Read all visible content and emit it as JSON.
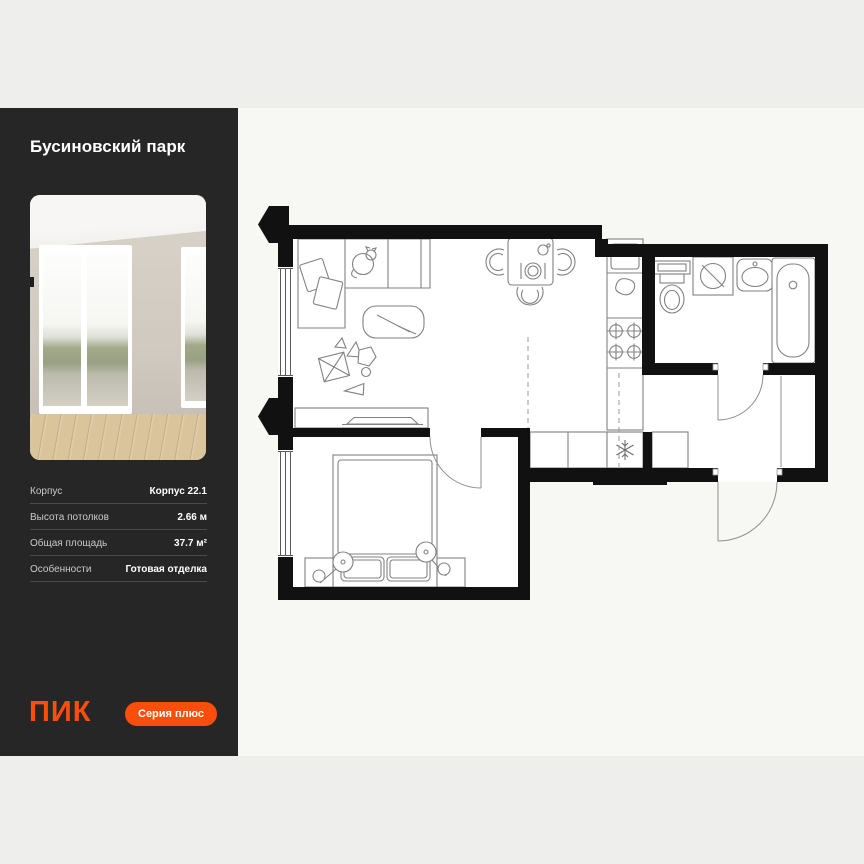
{
  "sidebar": {
    "title": "Бусиновский парк",
    "photo_alt": "interior-photo-empty-room-two-windows-wood-floor",
    "details": [
      {
        "label": "Корпус",
        "value": "Корпус 22.1"
      },
      {
        "label": "Высота потолков",
        "value": "2.66 м"
      },
      {
        "label": "Общая площадь",
        "value": "37.7 м²"
      },
      {
        "label": "Особенности",
        "value": "Готовая отделка"
      }
    ],
    "logo": "ПИК",
    "badge": "Серия плюс"
  },
  "floorplan": {
    "type": "apartment-floor-plan",
    "rooms": [
      "living-kitchen",
      "bedroom",
      "bathroom",
      "hallway"
    ],
    "elements": [
      "corner-sofa",
      "sofa-pillows",
      "cat",
      "coffee-table",
      "play-rug-toys",
      "tv-console",
      "dining-table",
      "dining-chairs",
      "kitchen-sink",
      "kitchen-stove",
      "fridge-snowflake",
      "wardrobe",
      "double-bed",
      "bed-pillows",
      "nightstands",
      "lamps",
      "toilet",
      "washing-machine",
      "bathroom-sink",
      "bathtub",
      "windows-left-wall",
      "entrance-door",
      "bathroom-door",
      "bedroom-door",
      "direction-arrows",
      "kitchen-zone-dashed-lines"
    ]
  },
  "colors": {
    "accent": "#FB4E0C",
    "sidebar_bg": "#262626",
    "page_bg": "#EEEEEC",
    "panel_bg": "#F7F7F4",
    "wall": "#111111",
    "plan_line": "#828282"
  }
}
